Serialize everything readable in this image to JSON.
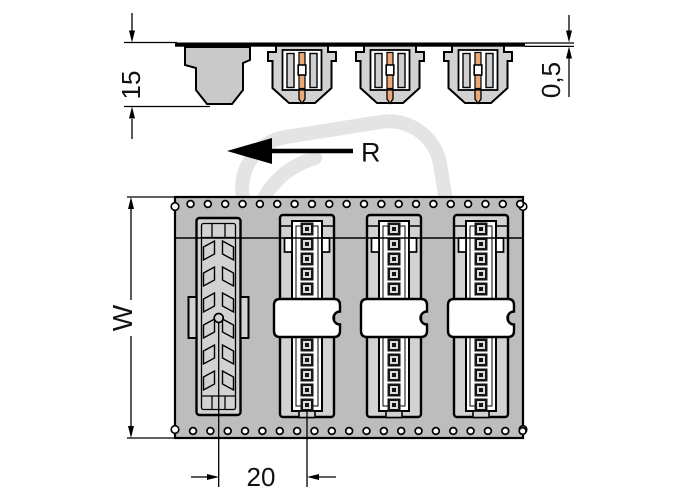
{
  "drawing_labels": {
    "connector_height": "15",
    "tape_thickness": "0,5",
    "tape_width": "W",
    "connector_pitch": "20",
    "unreeling_direction": "R"
  },
  "counts": {
    "sprocket_holes_top": 20,
    "sprocket_holes_bottom": 20,
    "front_view_connectors_top": 3,
    "front_view_connectors_bottom": 3,
    "contacts_per_connector_visible": 10,
    "slot_pairs_silhouette": 6
  },
  "colors": {
    "tape_fill": "#bdbdbd",
    "connector_body_fill": "#d2d2d2",
    "side_view_body_fill": "#d9d9d9",
    "silhouette_fill": "#c9c9c9",
    "pin_copper": "#eba878",
    "slot_fill": "#cfcfcf",
    "contact_dark": "#161616",
    "watermark": "#e4e4e4",
    "line": "#000000"
  }
}
